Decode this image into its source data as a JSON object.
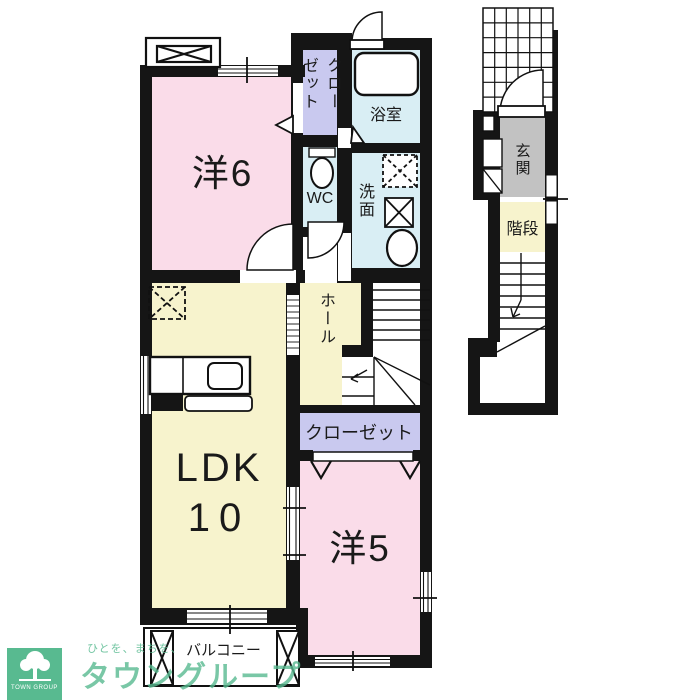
{
  "floorplan": {
    "rooms": {
      "western6": {
        "label": "洋6"
      },
      "closet_upper": {
        "label": "クローゼット"
      },
      "bathroom": {
        "label": "浴室"
      },
      "wc": {
        "label": "WC"
      },
      "washroom": {
        "label": "洗面"
      },
      "hall": {
        "label": "ホール"
      },
      "ldk": {
        "line1": "LDK",
        "line2": "10"
      },
      "closet_lower": {
        "label": "クローゼット"
      },
      "western5": {
        "label": "洋5"
      },
      "entrance": {
        "label": "玄関"
      },
      "stairs": {
        "label": "階段"
      },
      "balcony": {
        "label": "バルコニー"
      }
    },
    "colors": {
      "room_pink": "#fadce9",
      "room_yellow": "#f7f3cd",
      "room_purple": "#c9c9ef",
      "room_blue": "#d9eef4",
      "room_gray": "#c2c2c2",
      "wall_black": "#151515"
    }
  },
  "branding": {
    "logo_title": "TOWN GROUP",
    "tagline": "ひとを、まちを、",
    "company": "タウングループ",
    "brand_green": "#58ba90"
  }
}
